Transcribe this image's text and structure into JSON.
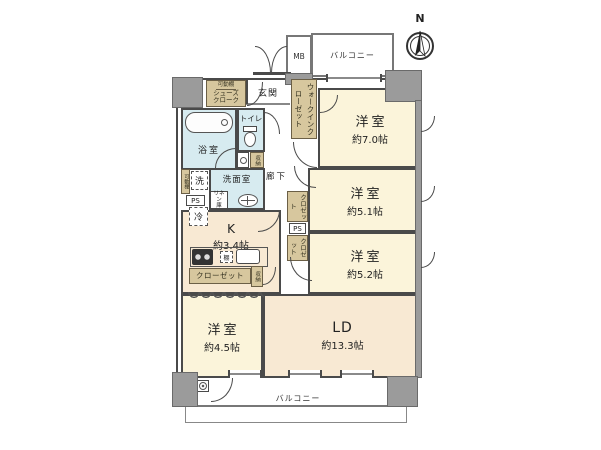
{
  "compass": {
    "label": "N"
  },
  "balcony_top": {
    "label": "バルコニー"
  },
  "balcony_bottom": {
    "label": "バルコニー"
  },
  "meter_box": {
    "label": "MB"
  },
  "entrance": {
    "label": "玄関"
  },
  "hallway": {
    "label": "廊下"
  },
  "shoes_closet": {
    "shelf": "可動棚",
    "name": "シューズ\nクローク"
  },
  "walk_in_closet": {
    "name": "ウォークインクローゼット"
  },
  "bathroom": {
    "name": "浴室"
  },
  "toilet": {
    "name": "トイレ"
  },
  "washroom": {
    "name": "洗面室"
  },
  "hall_storage": {
    "name": "収納"
  },
  "movable_shelf": {
    "name": "可動棚"
  },
  "washer": {
    "name": "洗"
  },
  "fridge": {
    "name": "冷"
  },
  "pipe_space_left": {
    "name": "PS"
  },
  "pipe_space_right": {
    "name": "PS"
  },
  "linen_storage": {
    "name": "リネン\n庫"
  },
  "kitchen": {
    "name": "K",
    "size": "約3.4帖",
    "shelf": "棚"
  },
  "west_closet": {
    "name": "クローゼット"
  },
  "west_storage": {
    "name": "収納"
  },
  "closet_room_51": {
    "name": "クロゼット"
  },
  "closet_room_52": {
    "name": "クロゼット"
  },
  "room_north": {
    "name": "洋室",
    "size": "約7.0帖"
  },
  "room_east_1": {
    "name": "洋室",
    "size": "約5.1帖"
  },
  "room_east_2": {
    "name": "洋室",
    "size": "約5.2帖"
  },
  "living_dining": {
    "name": "LD",
    "size": "約13.3帖"
  },
  "room_west": {
    "name": "洋室",
    "size": "約4.5帖"
  }
}
